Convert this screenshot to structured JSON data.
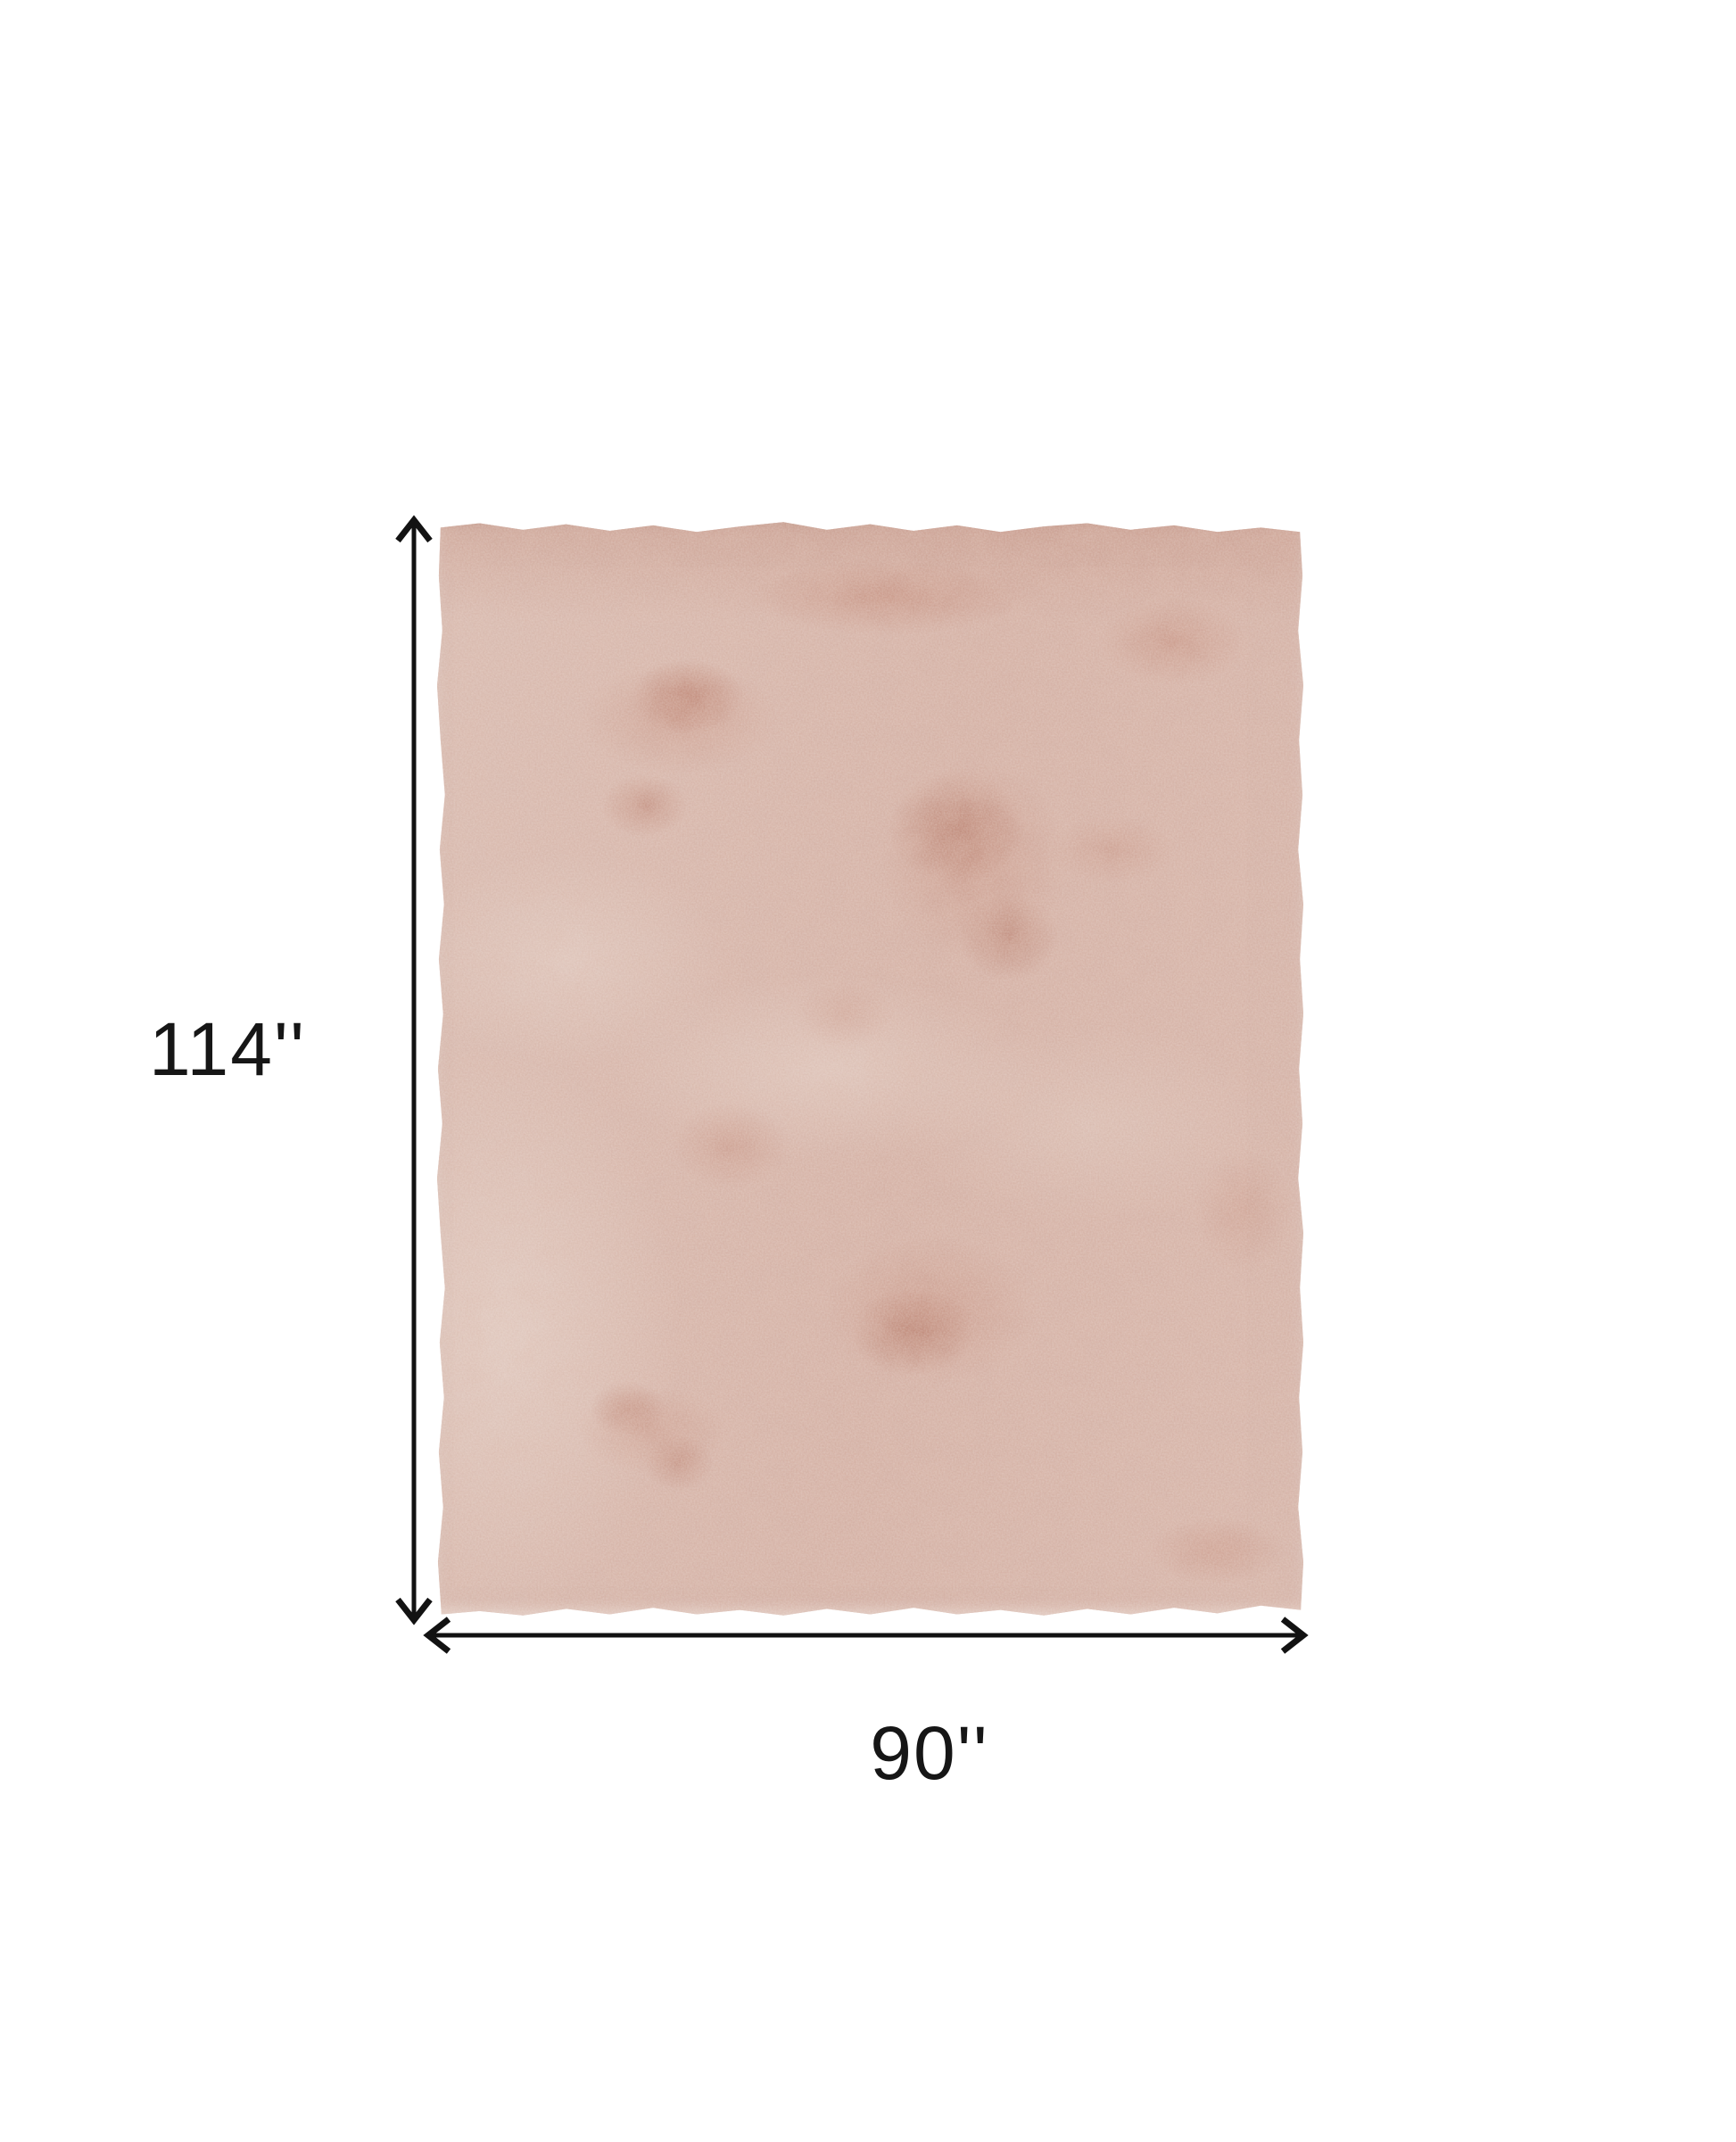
{
  "diagram": {
    "description": "Top view of a plush blush pink area rug with dimension arrows",
    "height_label": "114''",
    "width_label": "90''",
    "arrow_color": "#121212",
    "label_color": "#161616",
    "background_color": "#ffffff",
    "rug": {
      "base_color": "#d6b3a7",
      "light_plush_color": "#e6cfc5",
      "distressed_patch_color": "#bb8270",
      "deep_patch_color": "#aa6d5b"
    }
  }
}
